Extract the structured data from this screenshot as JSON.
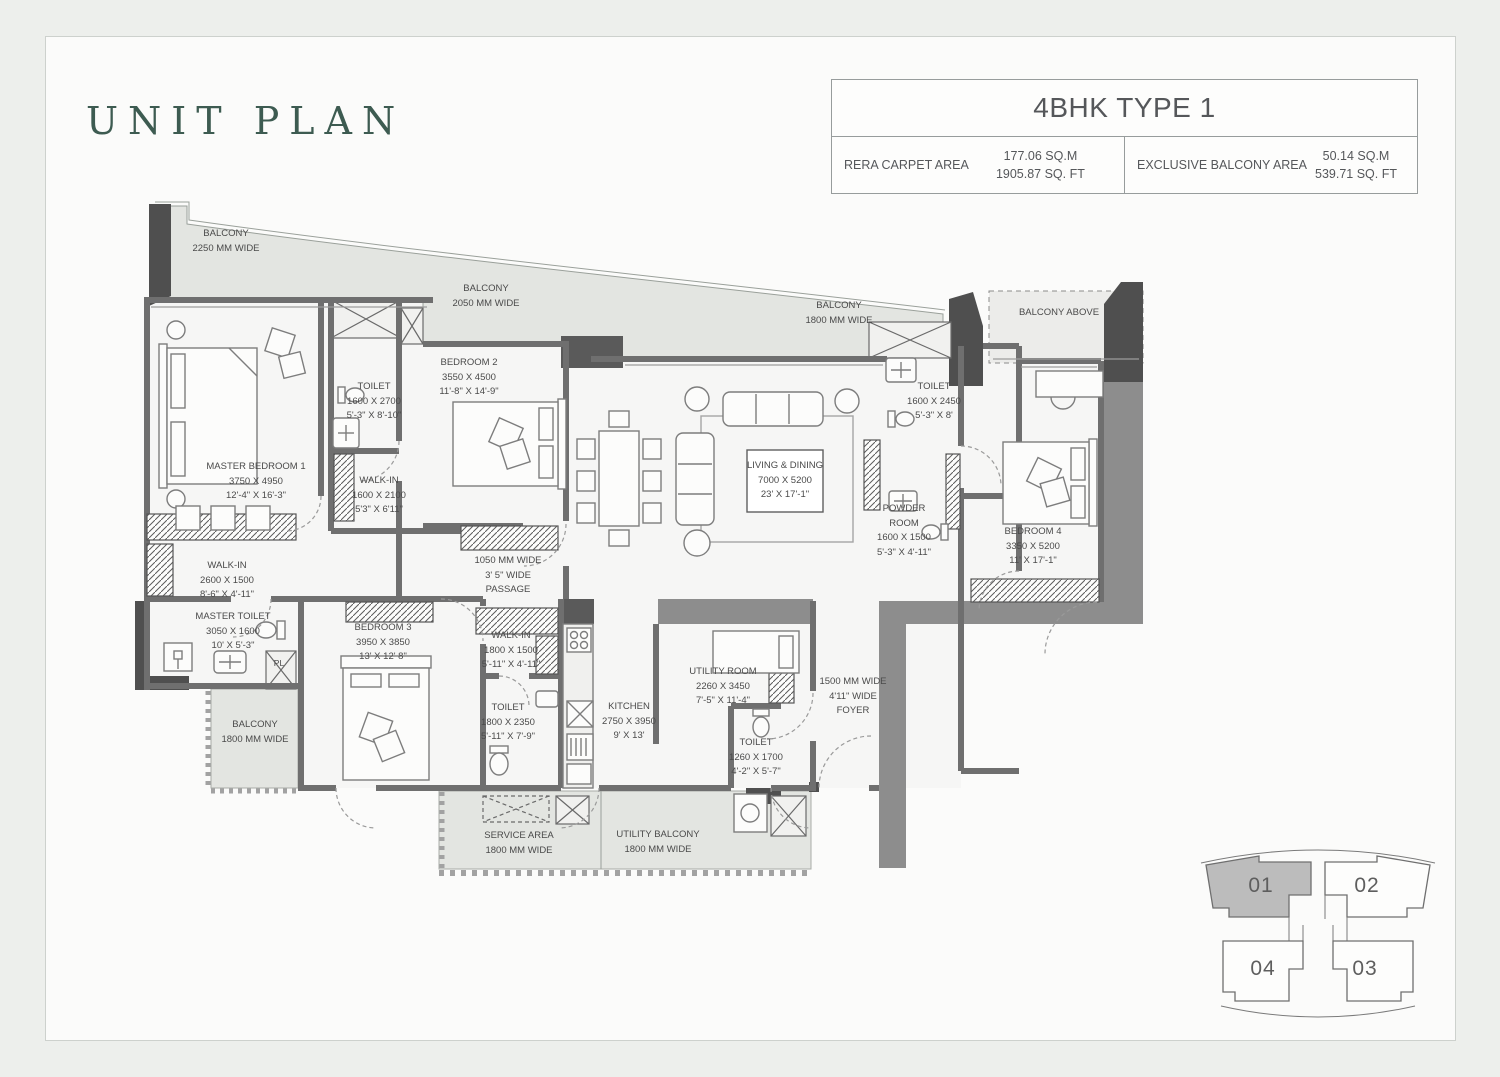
{
  "page": {
    "title": "UNIT PLAN"
  },
  "header": {
    "title": "4BHK TYPE 1",
    "cells": [
      {
        "label": "RERA CARPET AREA",
        "sqm": "177.06 SQ.M",
        "sqft": "1905.87 SQ. FT"
      },
      {
        "label": "EXCLUSIVE BALCONY AREA",
        "sqm": "50.14 SQ.M",
        "sqft": "539.71 SQ. FT"
      }
    ]
  },
  "colors": {
    "title_accent": "#3d5b51",
    "wall": "#6f6f6f",
    "balcony_fill": "#e3e5e1",
    "highlighted_unit_fill": "#bcbcbc"
  },
  "rooms": {
    "balcony_top_left": {
      "l1": "BALCONY",
      "l2": "2250 MM WIDE"
    },
    "balcony_top_mid": {
      "l1": "BALCONY",
      "l2": "2050 MM WIDE"
    },
    "balcony_top_right": {
      "l1": "BALCONY",
      "l2": "1800 MM WIDE"
    },
    "balcony_above": {
      "l1": "BALCONY ABOVE"
    },
    "master_bedroom_1": {
      "l1": "MASTER BEDROOM 1",
      "l2": "3750 X 4950",
      "l3": "12'-4\" X 16'-3\""
    },
    "toilet_mb": {
      "l1": "TOILET",
      "l2": "1600 X 2700",
      "l3": "5'-3\" X 8'-10\""
    },
    "walk_in_mb": {
      "l1": "WALK-IN",
      "l2": "1600 X 2100",
      "l3": "5'3\" X 6'11\""
    },
    "bedroom_2": {
      "l1": "BEDROOM 2",
      "l2": "3550 X 4500",
      "l3": "11'-8\" X 14'-9\""
    },
    "living_dining": {
      "l1": "LIVING & DINING",
      "l2": "7000 X 5200",
      "l3": "23' X 17'-1\""
    },
    "toilet_b4": {
      "l1": "TOILET",
      "l2": "1600 X 2450",
      "l3": "5'-3\" X 8'"
    },
    "powder_room": {
      "l1": "POWDER",
      "l2": "ROOM",
      "l3": "1600 X 1500",
      "l4": "5'-3\" X 4'-11\""
    },
    "bedroom_4": {
      "l1": "BEDROOM 4",
      "l2": "3350 X 5200",
      "l3": "11' X 17'-1\""
    },
    "walk_in_2600": {
      "l1": "WALK-IN",
      "l2": "2600 X 1500",
      "l3": "8'-6\" X 4'-11\""
    },
    "master_toilet": {
      "l1": "MASTER TOILET",
      "l2": "3050 X 1600",
      "l3": "10' X 5'-3\""
    },
    "balcony_left": {
      "l1": "BALCONY",
      "l2": "1800 MM WIDE"
    },
    "bedroom_3": {
      "l1": "BEDROOM 3",
      "l2": "3950 X 3850",
      "l3": "13' X 12' 8\""
    },
    "passage": {
      "l1": "1050 MM WIDE",
      "l2": "3' 5\" WIDE",
      "l3": "PASSAGE"
    },
    "walk_in_1800": {
      "l1": "WALK-IN",
      "l2": "1800 X 1500",
      "l3": "5'-11\" X 4'-11\""
    },
    "toilet_b3": {
      "l1": "TOILET",
      "l2": "1800 X 2350",
      "l3": "5'-11\" X 7'-9\""
    },
    "kitchen": {
      "l1": "KITCHEN",
      "l2": "2750 X 3950",
      "l3": "9' X 13'"
    },
    "utility_room": {
      "l1": "UTILITY ROOM",
      "l2": "2260 X 3450",
      "l3": "7'-5\" X 11'-4\""
    },
    "toilet_utility": {
      "l1": "TOILET",
      "l2": "1260 X 1700",
      "l3": "4'-2\" X 5'-7\""
    },
    "foyer": {
      "l1": "1500 MM WIDE",
      "l2": "4'11\" WIDE",
      "l3": "FOYER"
    },
    "service_area": {
      "l1": "SERVICE AREA",
      "l2": "1800 MM WIDE"
    },
    "utility_balcony": {
      "l1": "UTILITY BALCONY",
      "l2": "1800 MM WIDE"
    },
    "pl_shaft": {
      "l1": "PL"
    }
  },
  "keyplan": {
    "units": [
      {
        "id": "01",
        "highlighted": true
      },
      {
        "id": "02",
        "highlighted": false
      },
      {
        "id": "04",
        "highlighted": false
      },
      {
        "id": "03",
        "highlighted": false
      }
    ]
  }
}
